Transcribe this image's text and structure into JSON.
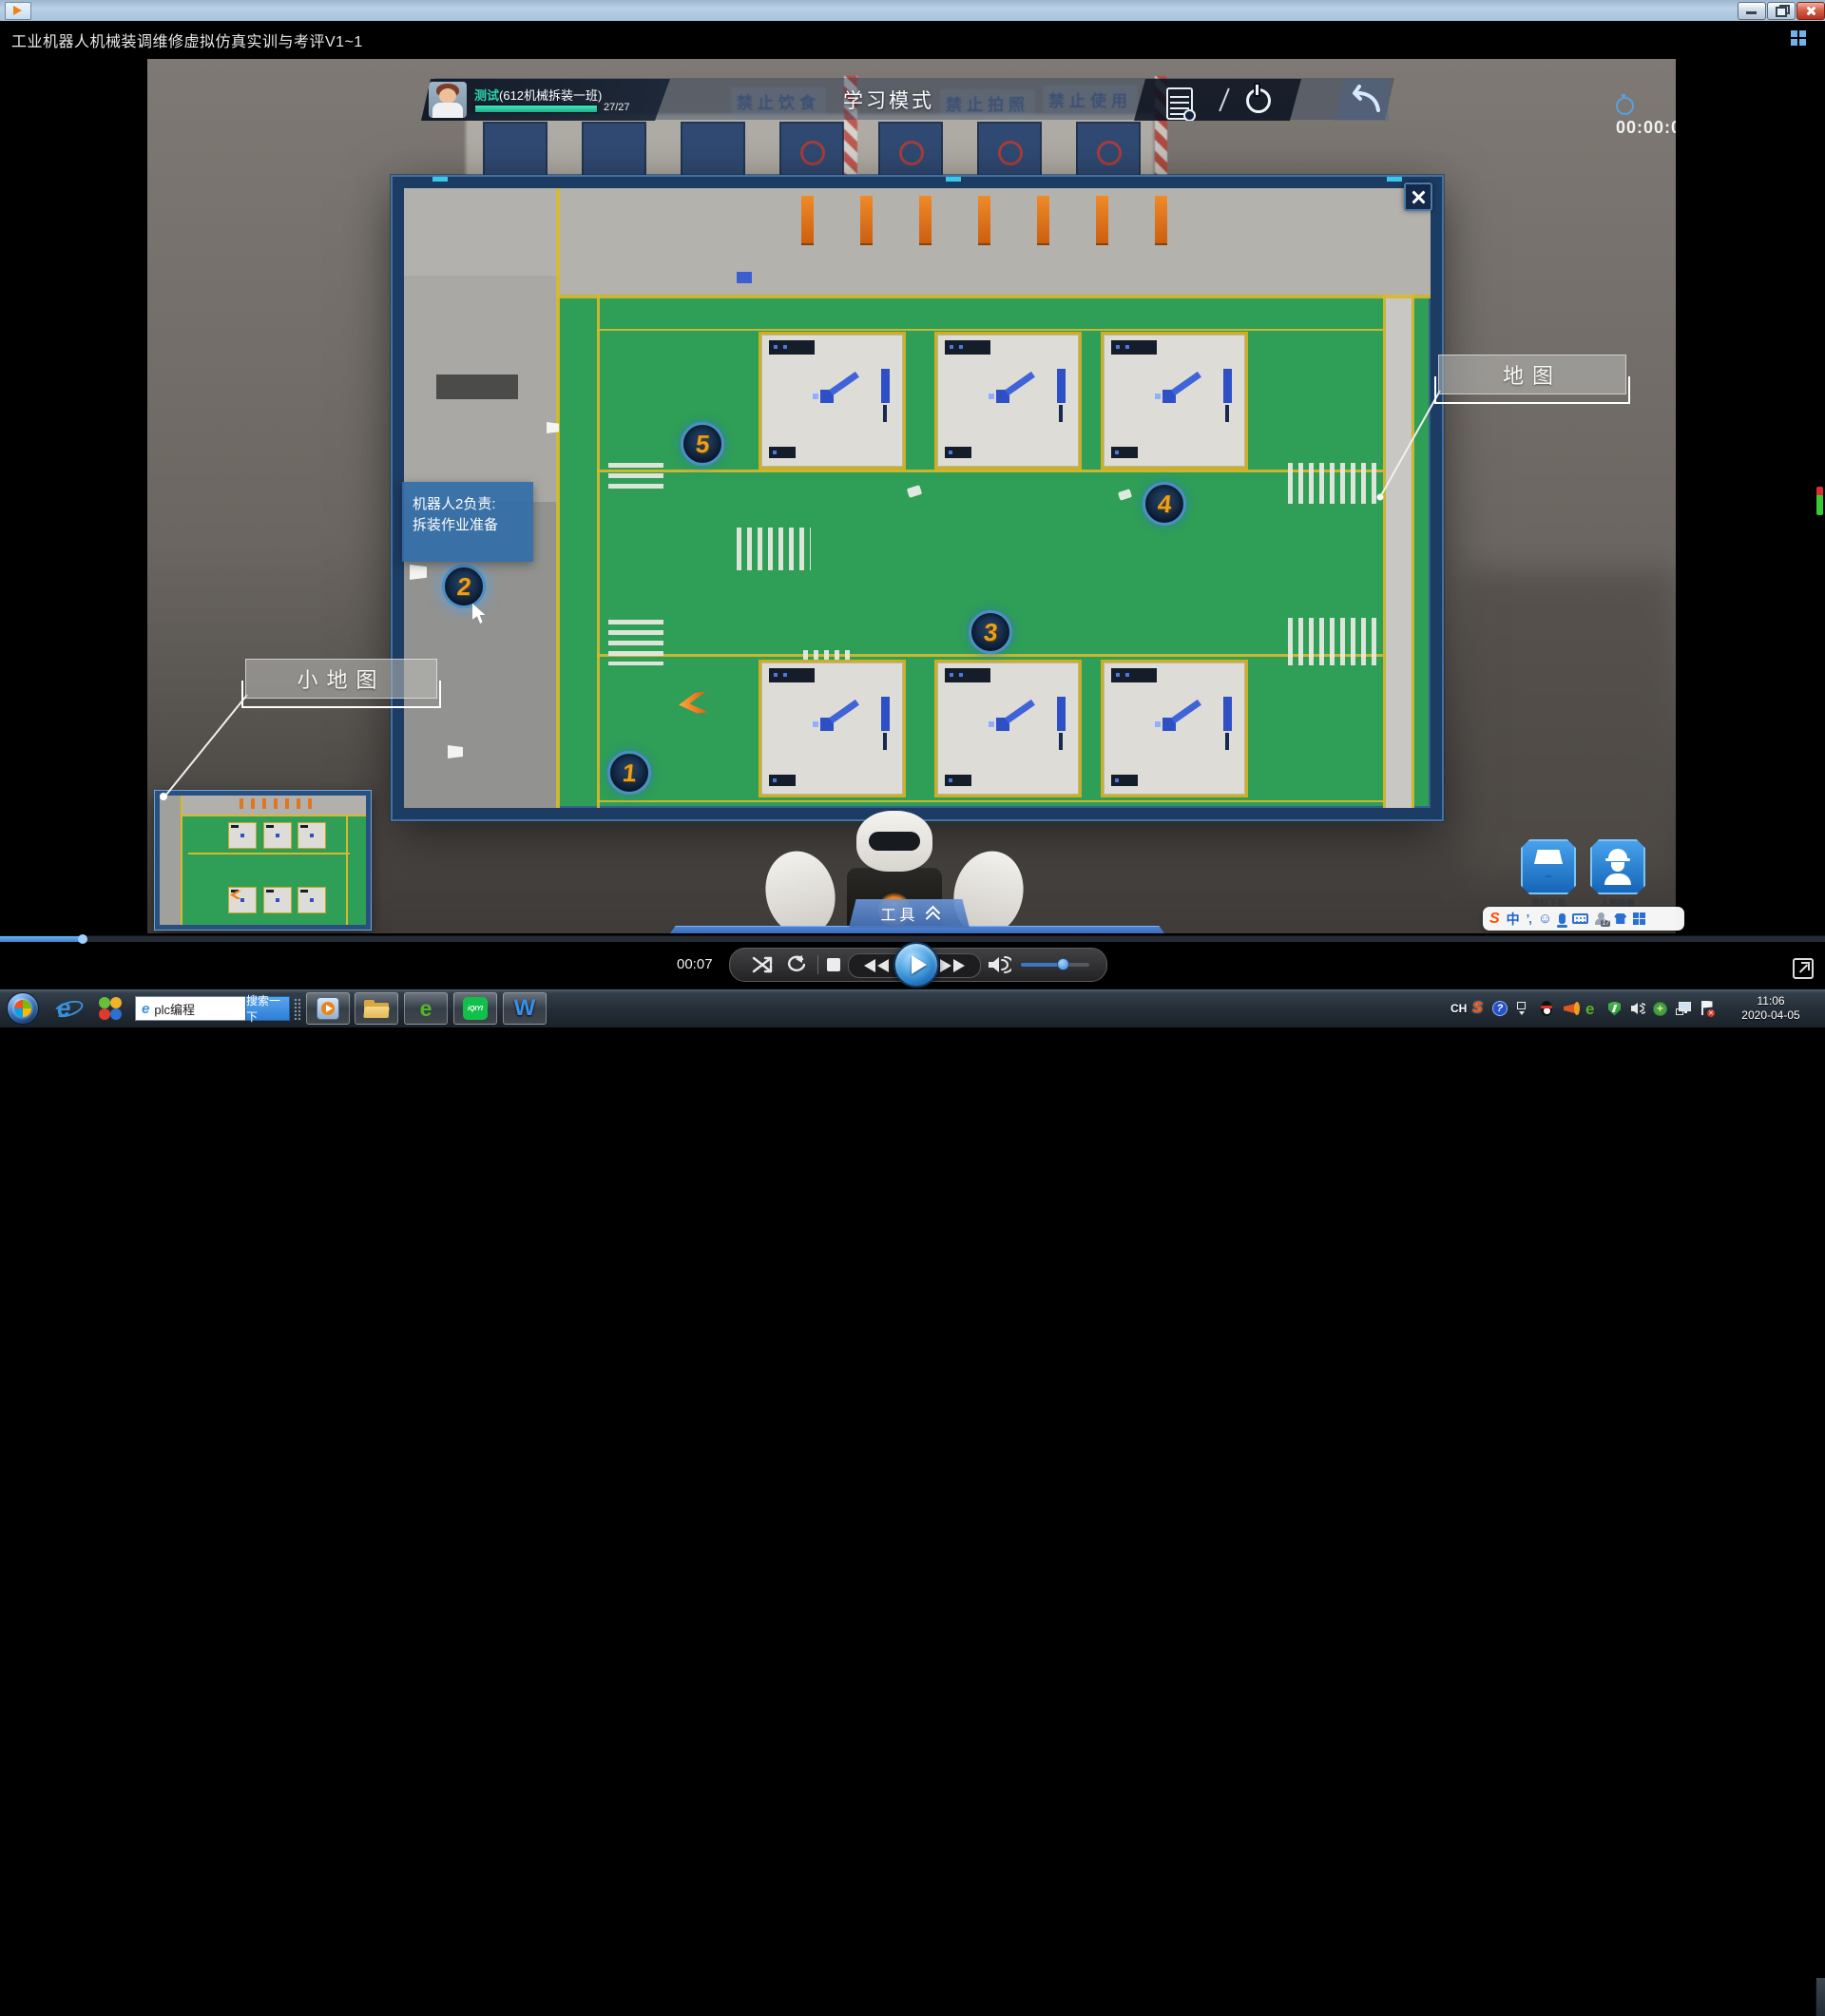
{
  "window": {
    "title": "工业机器人机械装调维修虚拟仿真实训与考评V1~1"
  },
  "hud": {
    "timer": "00:00:00",
    "user_name": "测试",
    "user_class": "(612机械拆装一班)",
    "progress": "27/27",
    "mode": "学习模式",
    "posters": {
      "p1": "禁止饮食",
      "p2": "禁止拍照",
      "p3": "禁止使用"
    }
  },
  "map": {
    "label": "地图",
    "minimap_label": "小地图",
    "tooltip_line1": "机器人2负责:",
    "tooltip_line2": "拆装作业准备",
    "markers": {
      "m1": "1",
      "m2": "2",
      "m3": "3",
      "m4": "4",
      "m5": "5"
    }
  },
  "tools": {
    "label": "工具"
  },
  "robot": {
    "badge": "1"
  },
  "actions": {
    "materials_label": "资料下载",
    "equipment_label": "人物装备"
  },
  "player": {
    "current_time": "00:07"
  },
  "ime": {
    "lang": "中",
    "logo": "S",
    "punct": "’,",
    "skin_badge": "17"
  },
  "taskbar": {
    "search_value": "plc编程",
    "search_button": "搜索一下",
    "wps": "W",
    "iqiyi": "iQIYI",
    "tray_lang": "CH",
    "tray_sogou": "S",
    "time": "11:06",
    "date": "2020-04-05"
  }
}
